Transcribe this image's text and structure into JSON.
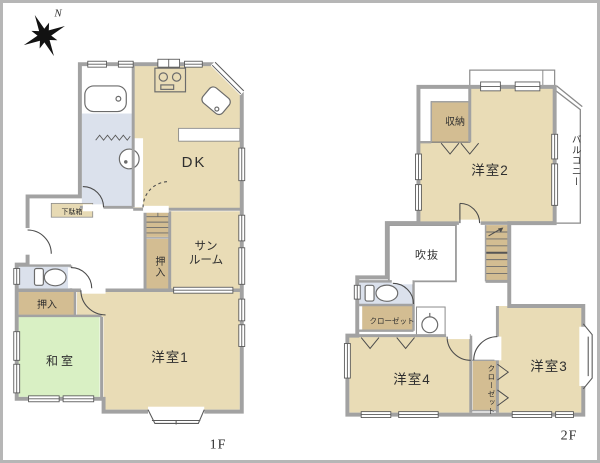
{
  "compass": {
    "label": "N"
  },
  "floor1": {
    "label": "1F",
    "rooms": {
      "dk": "DK",
      "sunroom": "サン\nルーム",
      "closet_by_stairs": "押入",
      "closet_west": "押入",
      "tatami_room": "和室",
      "western_room1": "洋室1",
      "shoe_cabinet": "下駄箱"
    }
  },
  "floor2": {
    "label": "2F",
    "rooms": {
      "storage": "収納",
      "western_room2": "洋室2",
      "balcony": "バルコニー",
      "atrium_void": "吹抜",
      "closet_hall": "クローゼット",
      "closet_between": "クローゼット",
      "western_room4": "洋室4",
      "western_room3": "洋室3"
    }
  },
  "colors": {
    "room_floor": "#e9dcb6",
    "closet_floor": "#d3bd92",
    "tatami_floor": "#d9f0c4",
    "wet_area": "#dbe1ec",
    "wall": "#a2a2a2",
    "thin_line": "#5a5a5a",
    "frame": "#b6b6b6",
    "label_text": "#2f2f2f"
  }
}
